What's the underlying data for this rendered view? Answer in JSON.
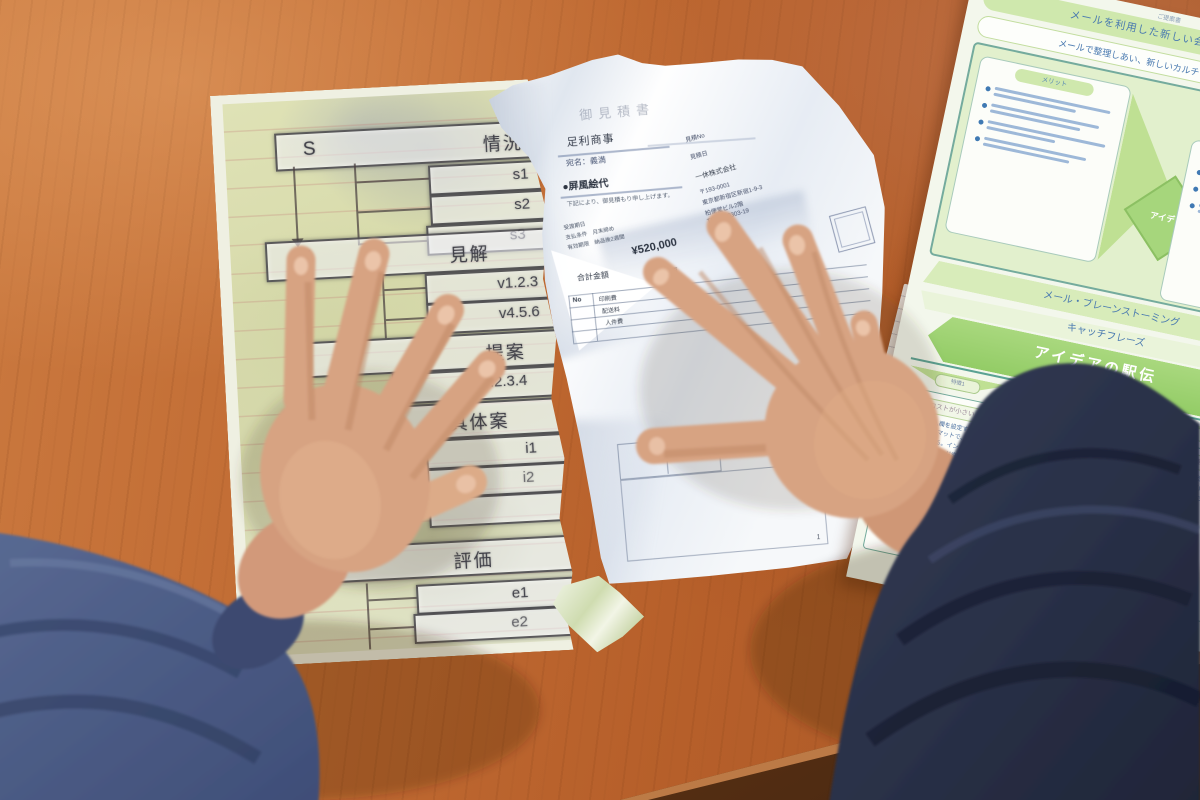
{
  "scene": {
    "description": "Overhead photo: two hands in navy padded jacket sleeves on an orange wooden desk, reviewing three printed Japanese business documents",
    "desk_color": "#bf6a33",
    "sleeve_left_color": "#4c5c86",
    "sleeve_right_color": "#262c40",
    "accent_green": "#cfe8ad",
    "accent_teal": "#5aa293",
    "text_blue": "#4a7ab0"
  },
  "left_worksheet": {
    "s_key": "S",
    "s_label": "情況",
    "s_items": [
      "s1",
      "s2",
      "s3"
    ],
    "v_key": "V",
    "v_label": "見解",
    "v_items": [
      "v1.2.3",
      "v4.5.6"
    ],
    "t_label": "提案",
    "t_items": [
      "i1.2.3.4"
    ],
    "g_label": "具体案",
    "g_items": [
      "i1",
      "i2"
    ],
    "e_label": "評価",
    "e_items": [
      "e1",
      "e2"
    ]
  },
  "estimate_doc": {
    "title": "御見積書",
    "client_company": "足利商事",
    "client_line": "宛名：義満",
    "subject": "●屏風絵代",
    "greeting": "下記により、御見積もり申し上げます。",
    "terms": [
      "受渡期日",
      "支払条件　月末締め",
      "有効期限　納品後2週間"
    ],
    "total_label": "合計金額",
    "total_value": "¥520,000",
    "table_no": "No",
    "table_summary": "概要",
    "table_rows": [
      "印刷費",
      "配送料",
      "人件費"
    ],
    "issuer_no": "見積No",
    "issuer_date": "見積日",
    "issuer_company": "一休株式会社",
    "issuer_postal": "〒193-0001",
    "issuer_address": "東京都新宿区新宿1-9-3",
    "issuer_building": "柏便堂ビル2階",
    "issuer_tel": "TEL 03-0303-19",
    "page_number": "1"
  },
  "green_sheet": {
    "tag": "ご提案書",
    "header": "メールを利用した新しい会議のご提案",
    "subheader": "メールで整理しあい、新しいカルチャーとして定着",
    "merit_label": "メリット",
    "point_label": "特徴",
    "idea_label": "アイデア",
    "band1": "メール・ブレーンストーミング",
    "band2": "キャッチフレーズ",
    "catch_title": "アイデアの駅伝",
    "catch_sub": "（頼りになる便り）",
    "features": [
      {
        "tag": "特徴1",
        "label": "コストが小さい",
        "text": "エクセルに記入欄を設定するだけという簡単なフォーマットで、全社的に広めることができる。イントラネットに蓄積すれば、ナレッジ資産となる。"
      },
      {
        "tag": "特徴2",
        "label": "書き込みが簡単",
        "text": "アイデアを求める人に送るとそれを聞いた人が書き込み、またいいアイデアを持っている人につないでいき、駅伝のように次々とアイデアがつむぎ出されていく。"
      },
      {
        "tag": "特徴3",
        "label": "会議が不要",
        "text": "従来必要だった根回しの作業がなくなってしまうので、事前に企画の概要を関係する人がわざわざ確認する必要がなくなる。"
      }
    ]
  }
}
